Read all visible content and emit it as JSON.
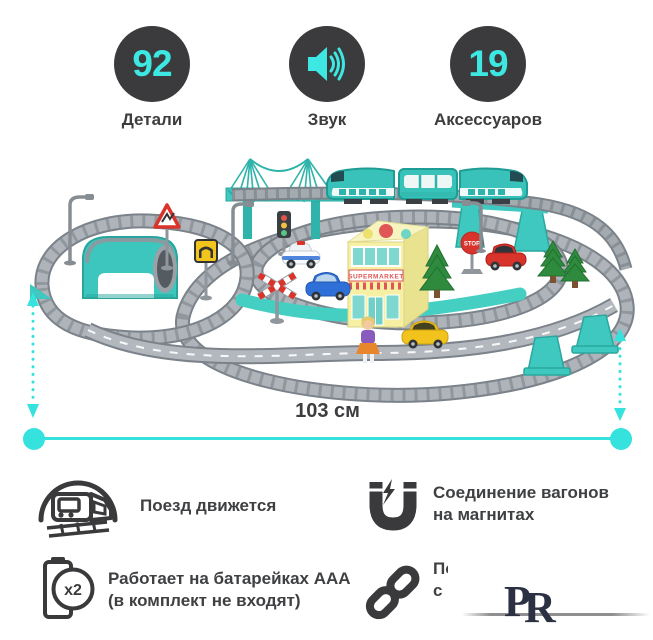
{
  "colors": {
    "accent": "#35e2de",
    "badge_background": "#3b3b3d",
    "badge_number": "#3ce8e1",
    "text_dark": "#3f4042",
    "toy_teal": "#3fc8bf",
    "track_gray": "#8f969c"
  },
  "badges": [
    {
      "value": "92",
      "label": "Детали"
    },
    {
      "icon": "speaker-icon",
      "label": "Звук"
    },
    {
      "value": "19",
      "label": "Аксессуаров"
    }
  ],
  "dimensions": {
    "width_label": "103 см"
  },
  "product_photo": {
    "building_sign": "SUPERMARKET",
    "stop_sign_text": "STOP"
  },
  "features": {
    "train": {
      "text": "Поезд движется"
    },
    "magnet": {
      "line1": "Соединение вагонов",
      "line2": "на магнитах"
    },
    "battery": {
      "badge": "x2",
      "line1": "Работает на батарейках AAA",
      "line2": "(в комплект не входят)"
    },
    "chain": {
      "line1": "По",
      "line2": "с"
    }
  },
  "watermark": {
    "letter1": "Р",
    "letter2": "R"
  }
}
